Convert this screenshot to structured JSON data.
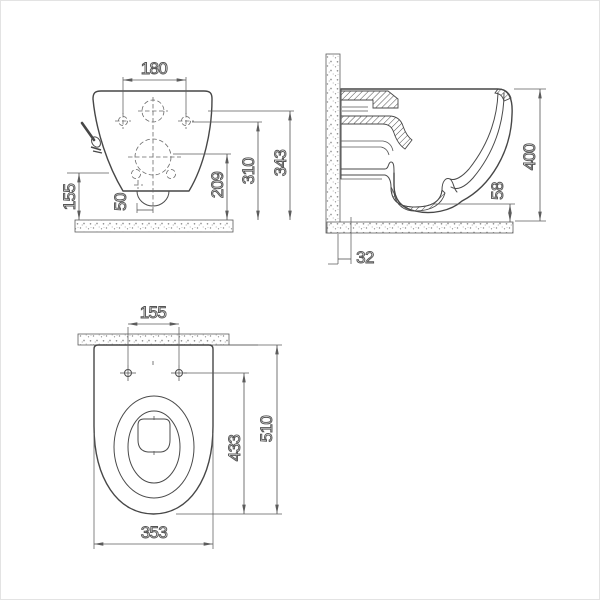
{
  "colors": {
    "line": "#4a4a4a",
    "background": "#ffffff",
    "texture_dots": "#8a8a8a"
  },
  "front_view": {
    "dims": {
      "fixing_hole_spacing": "180",
      "overall_height": "343",
      "fixing_holes_height": "310",
      "inlet_center_height": "209",
      "side_height": "155",
      "outlet_offset": "50"
    }
  },
  "side_view": {
    "dims": {
      "overall_height": "400",
      "floor_clearance": "58",
      "wall_offset": "32"
    }
  },
  "plan_view": {
    "dims": {
      "fixing_hole_spacing": "155",
      "overall_depth": "510",
      "hole_to_front_depth": "433",
      "overall_width": "353"
    }
  }
}
